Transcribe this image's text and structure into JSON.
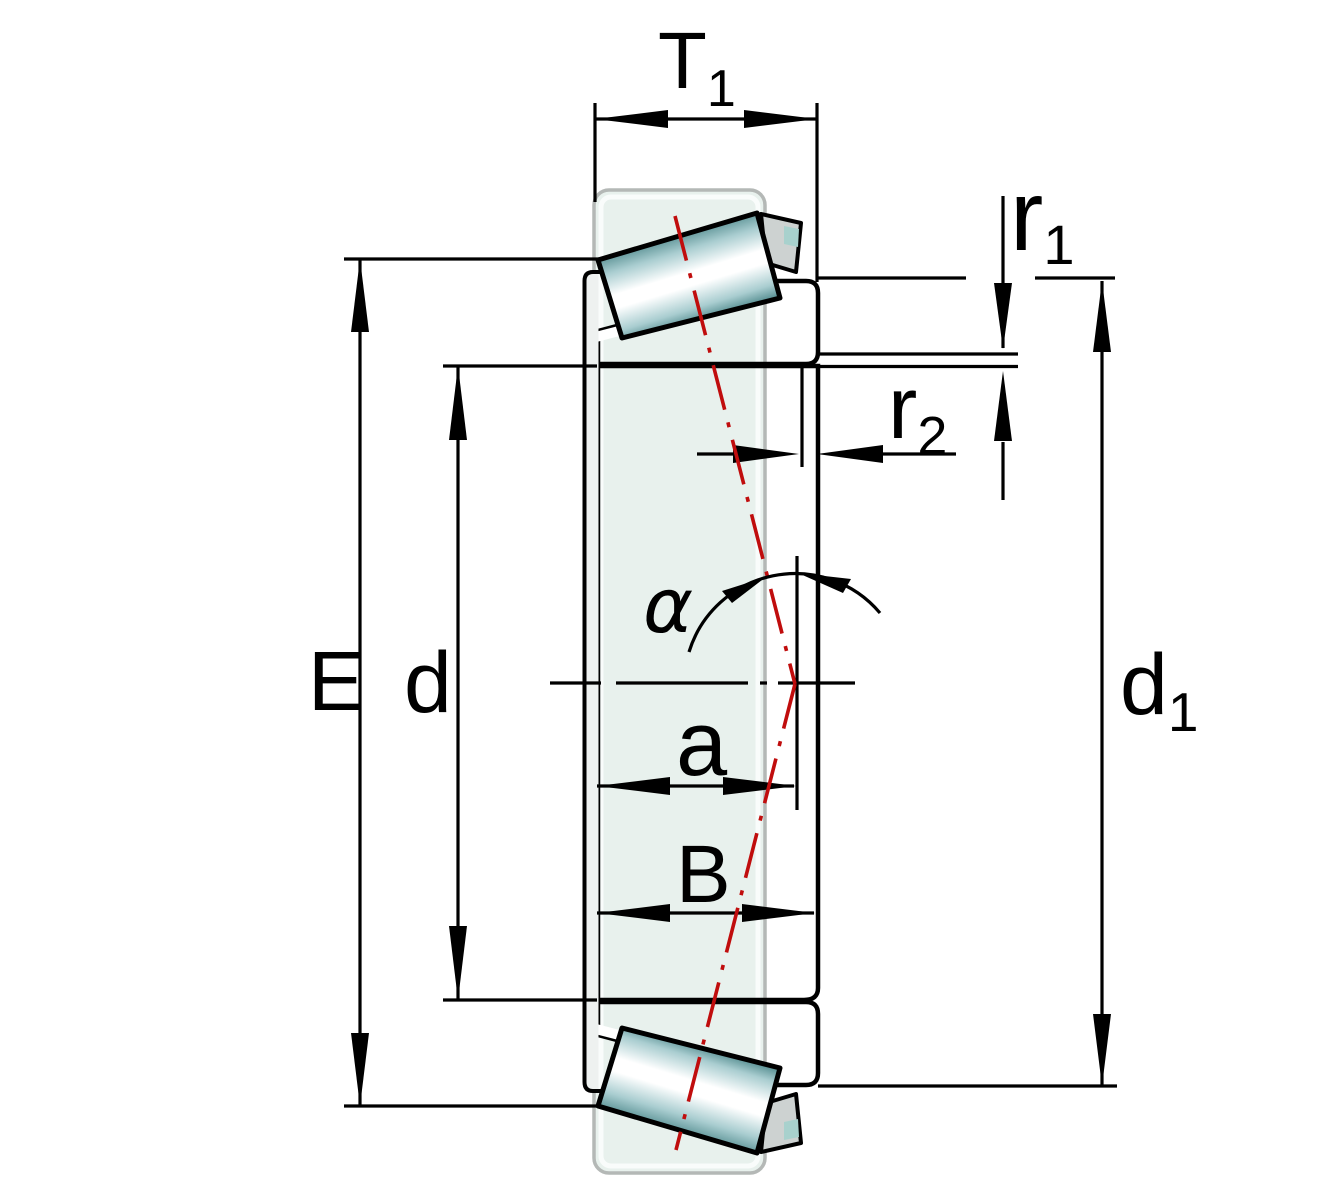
{
  "figure": {
    "title": "Tapered roller bearing cross-section with dimension symbols",
    "labels": {
      "t1_main": "T",
      "t1_sub": "1",
      "r1_main": "r",
      "r1_sub": "1",
      "r2_main": "r",
      "r2_sub": "2",
      "e": "E",
      "d": "d",
      "d1_main": "d",
      "d1_sub": "1",
      "a": "a",
      "b": "B",
      "alpha": "α"
    },
    "colors": {
      "part_teal": "#a8d1cd",
      "part_gray": "#dcdddd",
      "cage_gray": "#cdd2d1",
      "cage_fill": "#eef1f0",
      "cup_fill": "#e8f1ed",
      "cup_stroke": "#b4b8b6",
      "centerline_red": "#c00d0d",
      "line_black": "#000000",
      "roller_edge": "#578f92",
      "roller_mid": "#a9cdd0",
      "roller_highlight": "#ffffff"
    }
  }
}
